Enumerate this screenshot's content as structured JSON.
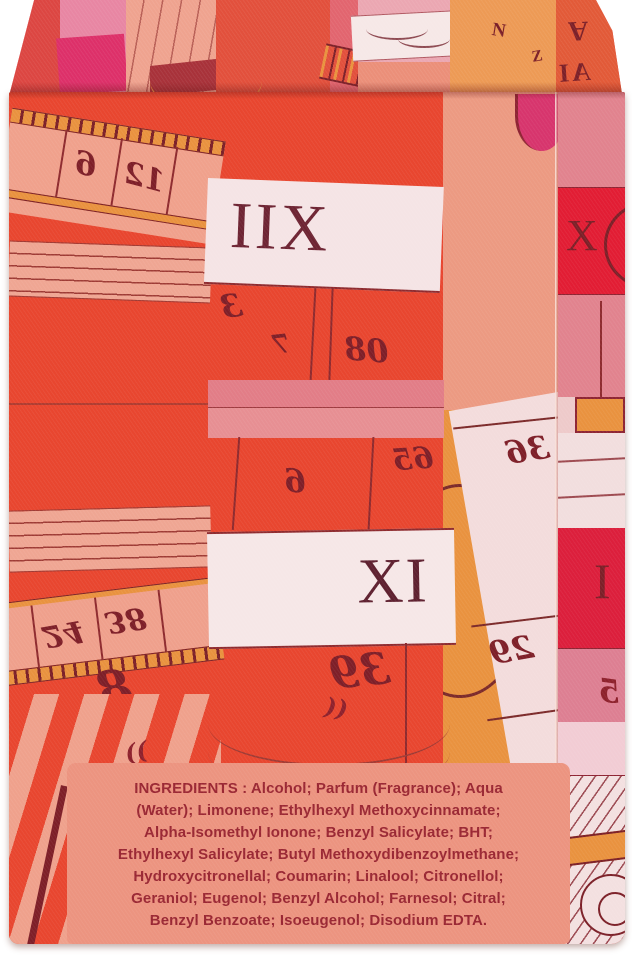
{
  "scene": {
    "description": "Perfume box rear face with abstract clock-dial scarf artwork and ingredients label"
  },
  "label": {
    "bg": "#ec9480",
    "text_color": "#9a2733",
    "lines": [
      "INGREDIENTS : Alcohol; Parfum (Fragrance); Aqua",
      "(Water); Limonene; Ethylhexyl Methoxycinnamate;",
      "Alpha-Isomethyl Ionone; Benzyl Salicylate; BHT;",
      "Ethylhexyl Salicylate; Butyl Methoxydibenzoylmethane;",
      "Hydroxycitronellal; Coumarin; Linalool; Citronellol;",
      "Geraniol; Eugenol; Benzyl Alcohol; Farnesol; Citral;",
      "Benzyl Benzoate; Isoeugenol; Disodium EDTA."
    ]
  },
  "artwork": {
    "romans": {
      "xii_mirrored": "IIX",
      "xi": "XI",
      "x_side": "X",
      "i_side": "I"
    },
    "numerals": {
      "six_top": "6",
      "twelve_top": "12",
      "three": "3",
      "seven": "7",
      "eighty_mirrored": "08",
      "six_mid": "6",
      "sixty_five": "65",
      "thirty_nine": "39",
      "twenty_four": "24",
      "thirty_eight": "38",
      "eight": "8",
      "thirty_six": "36",
      "twenty_nine": "29",
      "five_side": "5"
    },
    "marks": {
      "open_quotes": "((",
      "close_quotes": "))",
      "lid_n": "N",
      "lid_z": "Z",
      "lid_a": "A",
      "lid_ai": "AI"
    },
    "palette": {
      "red": "#e8462f",
      "salmon": "#ec9a82",
      "pale_pink": "#efa693",
      "blush_white": "#f5e4e5",
      "rose": "#e2808a",
      "magenta": "#d7356d",
      "bright_red": "#e21d34",
      "crimson": "#dc1f3c",
      "orange": "#e9923f",
      "maroon": "#7c2028",
      "label_bg": "#ec9480",
      "label_text": "#9a2733"
    }
  }
}
